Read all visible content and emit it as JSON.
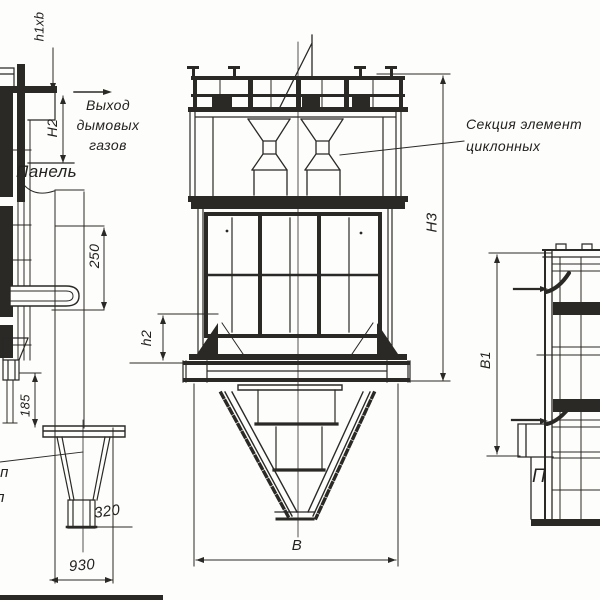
{
  "drawing_type": "cyclone-dust-collector-technical-drawing",
  "labels": {
    "gas_exit": [
      "Выход",
      "дымовых",
      "газов"
    ],
    "panel": "Панель",
    "section": [
      "Секция элемент",
      "циклонных"
    ],
    "partial_label": "П",
    "edge_fragment_top": "чп",
    "edge_fragment_bottom": "л"
  },
  "dimensions": {
    "h1xb": "h1хb",
    "H2": "Н2",
    "panel_250": "250",
    "gap_185": "185",
    "spout_320": "320",
    "base_930": "930",
    "h2": "h2",
    "H3": "Н3",
    "width_B": "В",
    "depth_B1": "В1"
  },
  "colors": {
    "line": "#2b2926",
    "background": "#fdfdfb"
  }
}
